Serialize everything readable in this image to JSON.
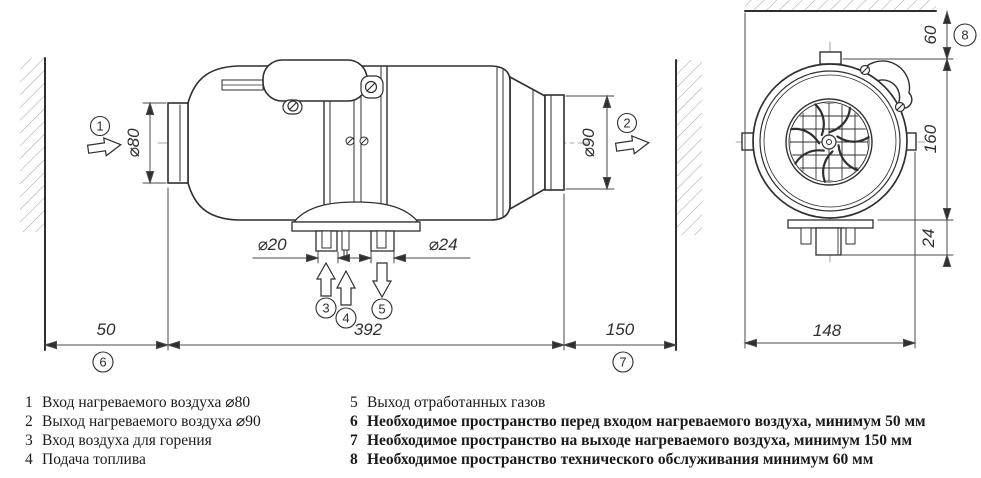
{
  "dims": {
    "d80": "⌀80",
    "d90": "⌀90",
    "d20": "⌀20",
    "d24": "⌀24",
    "len_front": "50",
    "len_body": "392",
    "len_rear": "150",
    "h_top": "60",
    "h_body": "160",
    "h_pipes": "24",
    "w_body": "148"
  },
  "callouts": {
    "c1": "1",
    "c2": "2",
    "c3": "3",
    "c4": "4",
    "c5": "5",
    "c6": "6",
    "c7": "7",
    "c8": "8"
  },
  "legend": {
    "left": [
      {
        "num": "1",
        "text": "Вход нагреваемого воздуха ⌀80"
      },
      {
        "num": "2",
        "text": "Выход нагреваемого воздуха ⌀90"
      },
      {
        "num": "3",
        "text": "Вход воздуха для горения"
      },
      {
        "num": "4",
        "text": "Подача топлива"
      }
    ],
    "right": [
      {
        "num": "5",
        "text": "Выход отработанных газов"
      },
      {
        "num": "6",
        "text": "Необходимое пространство перед входом нагреваемого воздуха, минимум 50 мм"
      },
      {
        "num": "7",
        "text": "Необходимое пространство на выходе нагреваемого воздуха, минимум 150 мм"
      },
      {
        "num": "8",
        "text": "Необходимое пространство технического обслуживания минимум 60 мм"
      }
    ]
  },
  "colors": {
    "line": "#2f2f2f",
    "dim": "#4a4a4a",
    "hatch": "#a8a8a8",
    "background": "#ffffff"
  }
}
